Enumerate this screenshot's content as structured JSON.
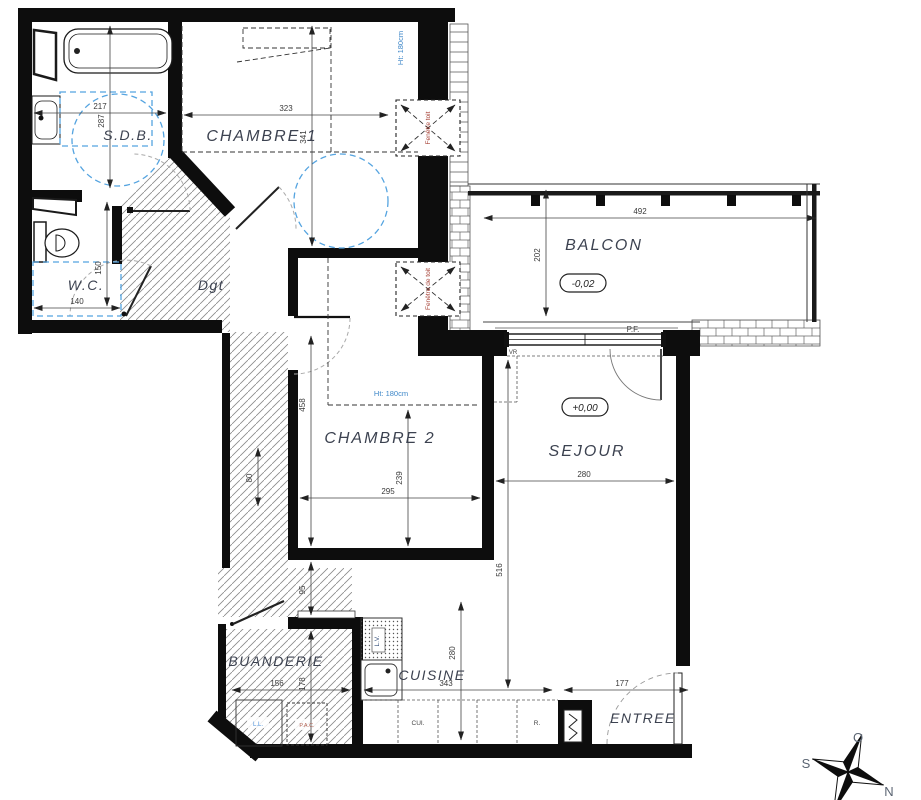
{
  "drawing": {
    "type": "apartment-floor-plan",
    "language": "fr"
  },
  "rooms": {
    "sdb": "S.D.B.",
    "chambre1": "CHAMBRE 1",
    "wc": "W.C.",
    "dgt": "Dgt",
    "balcon": "BALCON",
    "chambre2": "CHAMBRE 2",
    "sejour": "SEJOUR",
    "buanderie": "BUANDERIE",
    "cuisine": "CUISINE",
    "entree": "ENTREE"
  },
  "levels": {
    "balcon": "-0,02",
    "sejour": "+0,00"
  },
  "dims": {
    "sdb_w": "217",
    "sdb_h": "287",
    "ch1_w": "323",
    "ch1_h": "341",
    "wc_w": "140",
    "wc_h": "150",
    "balcon_w": "492",
    "balcon_h": "202",
    "ch2_w": "295",
    "ch2_h": "239",
    "strip_a": "458",
    "strip_b": "95",
    "strip_c": "178",
    "strip_d": "80",
    "sejour_w": "280",
    "sejour_h": "516",
    "cuisine_w": "343",
    "cuisine_h": "280",
    "buanderie_w": "156",
    "entree_w": "177"
  },
  "ann": {
    "ht1": "Ht: 180cm",
    "ht2": "Ht: 180cm",
    "roof1": "Fenêtre toit",
    "roof2": "Fenêtre de toit",
    "pf": "P.F.",
    "vr": "VR",
    "lv": "L.V.",
    "cui": "CUI.",
    "refr": "R.",
    "ll": "L.L.",
    "pac": "P.A.C."
  },
  "compass": {
    "o": "O",
    "s": "S",
    "n": "N"
  },
  "colors": {
    "wall": "#0d0d0d",
    "accent_blue": "#55a4e0",
    "accent_red": "#a8453a"
  }
}
